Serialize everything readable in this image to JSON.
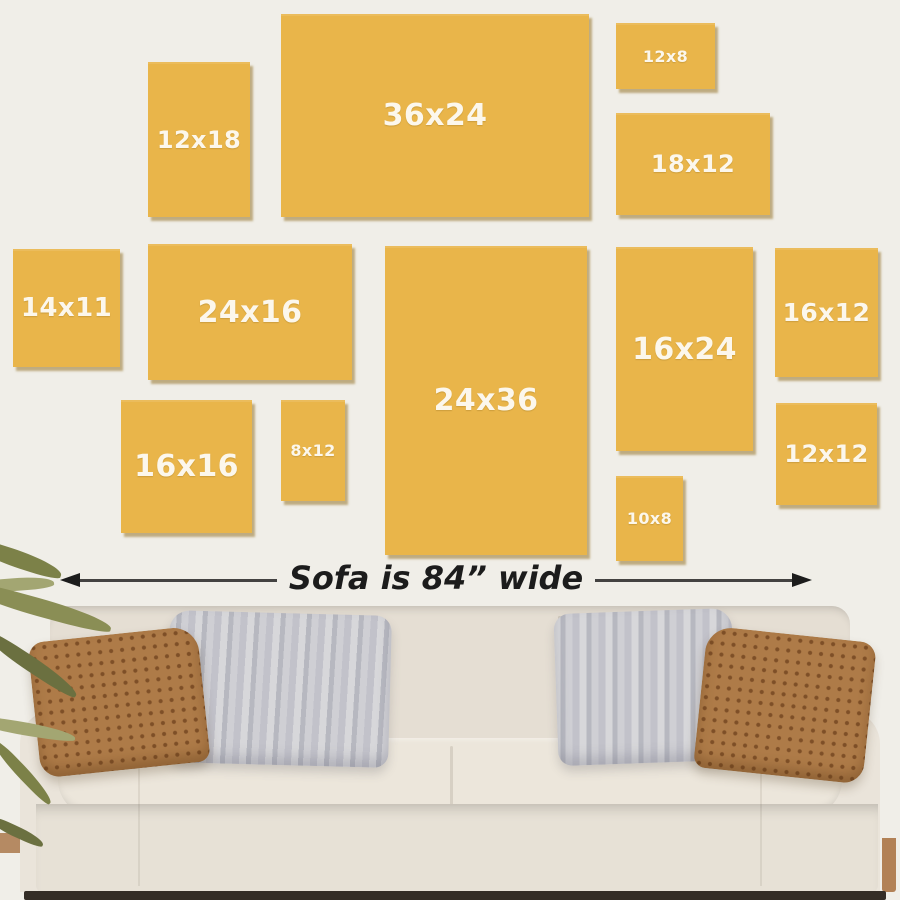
{
  "diagram": {
    "caption": "Sofa is 84” wide",
    "frames": [
      {
        "label": "12x18",
        "x": 148,
        "y": 62,
        "w": 102,
        "h": 155
      },
      {
        "label": "36x24",
        "x": 281,
        "y": 14,
        "w": 308,
        "h": 203
      },
      {
        "label": "12x8",
        "x": 616,
        "y": 23,
        "w": 99,
        "h": 66
      },
      {
        "label": "18x12",
        "x": 616,
        "y": 113,
        "w": 154,
        "h": 102
      },
      {
        "label": "14x11",
        "x": 13,
        "y": 249,
        "w": 107,
        "h": 118
      },
      {
        "label": "24x16",
        "x": 148,
        "y": 244,
        "w": 204,
        "h": 136
      },
      {
        "label": "24x36",
        "x": 385,
        "y": 246,
        "w": 202,
        "h": 309
      },
      {
        "label": "16x24",
        "x": 616,
        "y": 247,
        "w": 137,
        "h": 204
      },
      {
        "label": "16x12",
        "x": 775,
        "y": 248,
        "w": 103,
        "h": 129
      },
      {
        "label": "16x16",
        "x": 121,
        "y": 400,
        "w": 131,
        "h": 133
      },
      {
        "label": "8x12",
        "x": 281,
        "y": 400,
        "w": 64,
        "h": 101
      },
      {
        "label": "10x8",
        "x": 616,
        "y": 476,
        "w": 67,
        "h": 85
      },
      {
        "label": "12x12",
        "x": 776,
        "y": 403,
        "w": 101,
        "h": 102
      }
    ]
  },
  "icons": {
    "arrowhead_left": "left-pointing-triangle",
    "arrowhead_right": "right-pointing-triangle"
  },
  "colors": {
    "wall": "#F0EEE8",
    "frame_fill": "#E9B54A",
    "frame_label": "#FCF7EC",
    "ink": "#1C1C1C",
    "sofa_back": "#E5DED3",
    "sofa_arm": "#EAE4DA",
    "sofa_seat": "#ECE6DB",
    "sofa_base": "#E7E1D6",
    "pillow_brown": "#AE7B48",
    "pillow_brown_dot": "#7E4F27",
    "pillow_gray_light": "#D7D7DA",
    "pillow_gray_dark": "#B7B8C0",
    "leaf_dark": "#6B7040",
    "leaf_mid": "#7C8148",
    "leaf_light": "#A3A672",
    "floor_wood": "#B58A63",
    "floor_dark": "#342D26",
    "leg_wood": "#B28156"
  }
}
